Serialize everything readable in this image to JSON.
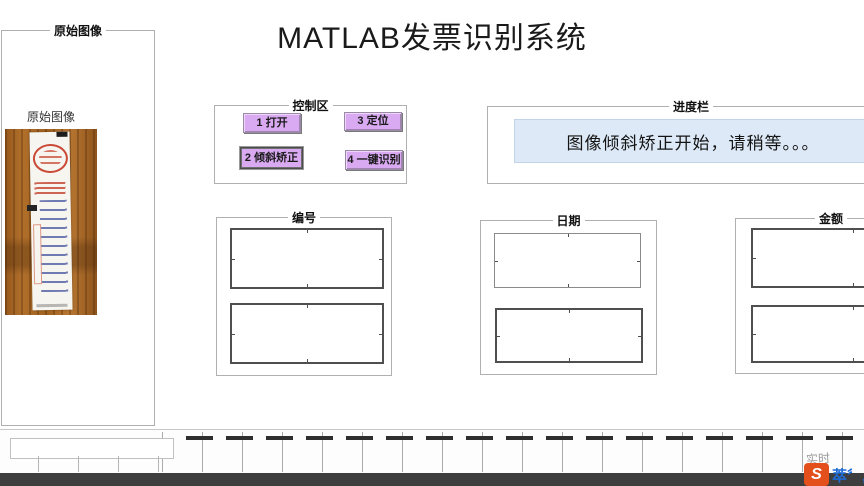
{
  "title": "MATLAB发票识别系统",
  "panels": {
    "original_image": {
      "label": "原始图像",
      "axes_title": "原始图像"
    },
    "control": {
      "label": "控制区",
      "buttons": [
        {
          "label": "1 打开"
        },
        {
          "label": "2 倾斜矫正"
        },
        {
          "label": "3 定位"
        },
        {
          "label": "4 一键识别"
        }
      ]
    },
    "progress": {
      "label": "进度栏",
      "message": "图像倾斜矫正开始，请稍等。。。"
    },
    "results": [
      {
        "label": "编号"
      },
      {
        "label": "日期"
      },
      {
        "label": "金额"
      }
    ]
  },
  "watermark": {
    "small_text": "实时",
    "logo_letter": "S",
    "logo_text": "萃〞,"
  },
  "colors": {
    "button_bg": "#d9a9f1",
    "progress_box_bg": "#dde9f7",
    "logo_orange": "#e4501c",
    "logo_blue": "#1e6bd6",
    "dark_bar": "#3e3e3e"
  }
}
